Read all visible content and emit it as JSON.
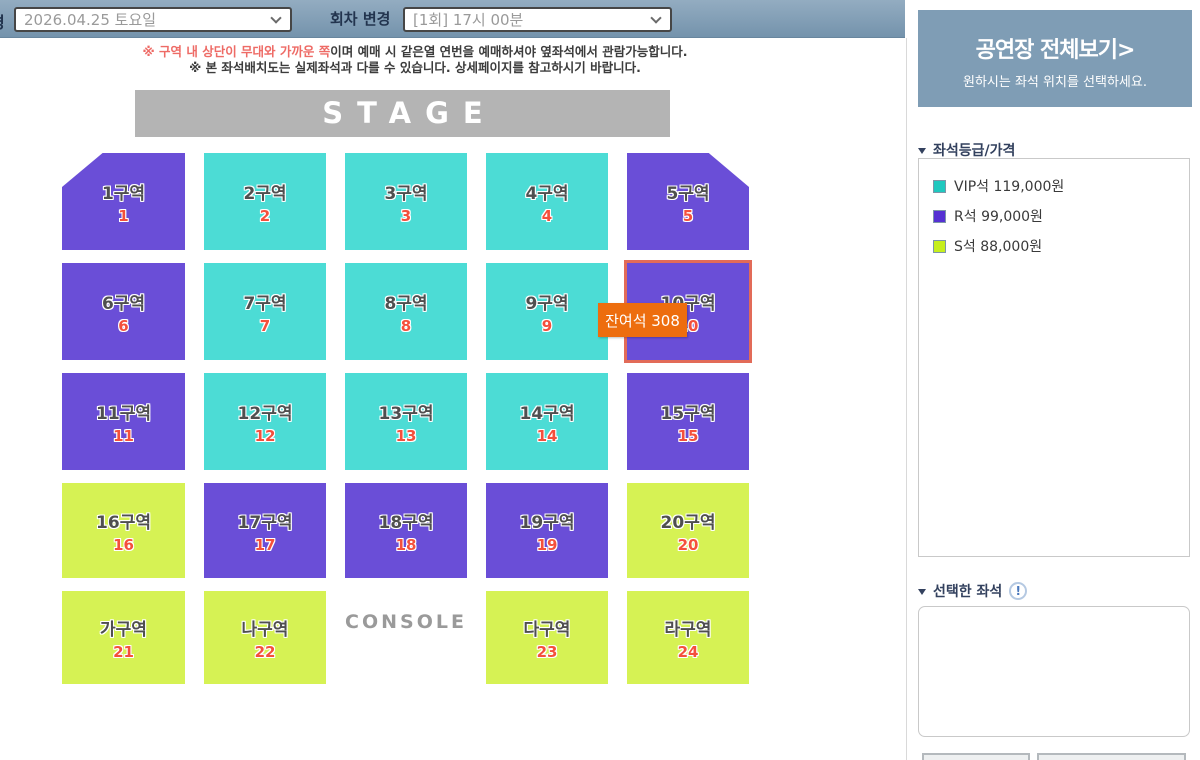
{
  "header": {
    "date_label_partial": "경",
    "date_value": "2026.04.25 토요일",
    "round_label": "회차 변경",
    "round_value": "[1회] 17시 00분"
  },
  "notices": {
    "line1_red": "※ 구역 내 상단이 무대와 가까운 쪽",
    "line1_rest": "이며 예매 시 같은열 연번을 예매하셔야 옆좌석에서 관람가능합니다.",
    "line2": "※ 본 좌석배치도는 실제좌석과 다를 수 있습니다. 상세페이지를 참고하시기 바랍니다."
  },
  "stage_label": "STAGE",
  "console_label": "CONSOLE",
  "tooltip": {
    "text": "잔여석 308"
  },
  "seat_map": {
    "sections": [
      {
        "label": "1구역",
        "number": "1",
        "grade": "R",
        "row": 1,
        "col": 1,
        "shape": "cut-left"
      },
      {
        "label": "2구역",
        "number": "2",
        "grade": "VIP",
        "row": 1,
        "col": 2
      },
      {
        "label": "3구역",
        "number": "3",
        "grade": "VIP",
        "row": 1,
        "col": 3
      },
      {
        "label": "4구역",
        "number": "4",
        "grade": "VIP",
        "row": 1,
        "col": 4
      },
      {
        "label": "5구역",
        "number": "5",
        "grade": "R",
        "row": 1,
        "col": 5,
        "shape": "cut-right"
      },
      {
        "label": "6구역",
        "number": "6",
        "grade": "R",
        "row": 2,
        "col": 1
      },
      {
        "label": "7구역",
        "number": "7",
        "grade": "VIP",
        "row": 2,
        "col": 2
      },
      {
        "label": "8구역",
        "number": "8",
        "grade": "VIP",
        "row": 2,
        "col": 3
      },
      {
        "label": "9구역",
        "number": "9",
        "grade": "VIP",
        "row": 2,
        "col": 4
      },
      {
        "label": "10구역",
        "number": "10",
        "grade": "R",
        "row": 2,
        "col": 5,
        "highlighted": true
      },
      {
        "label": "11구역",
        "number": "11",
        "grade": "R",
        "row": 3,
        "col": 1
      },
      {
        "label": "12구역",
        "number": "12",
        "grade": "VIP",
        "row": 3,
        "col": 2
      },
      {
        "label": "13구역",
        "number": "13",
        "grade": "VIP",
        "row": 3,
        "col": 3
      },
      {
        "label": "14구역",
        "number": "14",
        "grade": "VIP",
        "row": 3,
        "col": 4
      },
      {
        "label": "15구역",
        "number": "15",
        "grade": "R",
        "row": 3,
        "col": 5
      },
      {
        "label": "16구역",
        "number": "16",
        "grade": "S",
        "row": 4,
        "col": 1
      },
      {
        "label": "17구역",
        "number": "17",
        "grade": "R",
        "row": 4,
        "col": 2
      },
      {
        "label": "18구역",
        "number": "18",
        "grade": "R",
        "row": 4,
        "col": 3
      },
      {
        "label": "19구역",
        "number": "19",
        "grade": "R",
        "row": 4,
        "col": 4
      },
      {
        "label": "20구역",
        "number": "20",
        "grade": "S",
        "row": 4,
        "col": 5
      },
      {
        "label": "가구역",
        "number": "21",
        "grade": "S",
        "row": 5,
        "col": 1
      },
      {
        "label": "나구역",
        "number": "22",
        "grade": "S",
        "row": 5,
        "col": 2
      },
      {
        "label": "다구역",
        "number": "23",
        "grade": "S",
        "row": 5,
        "col": 4
      },
      {
        "label": "라구역",
        "number": "24",
        "grade": "S",
        "row": 5,
        "col": 5
      }
    ]
  },
  "sidebar": {
    "overview_title": "공연장 전체보기>",
    "overview_subtitle": "원하시는 좌석 위치를 선택하세요.",
    "price_title": "좌석등급/가격",
    "price_items": [
      {
        "grade": "VIP석",
        "price": "119,000원",
        "color": "#1fc8bf"
      },
      {
        "grade": "R석",
        "price": "99,000원",
        "color": "#5531d3"
      },
      {
        "grade": "S석",
        "price": "88,000원",
        "color": "#c6ef1d"
      }
    ],
    "selected_title": "선택한 좌석",
    "info_icon": "!"
  },
  "colors": {
    "grade_vip_fill": "#4cdcd5",
    "grade_r_fill": "#6a4ed7",
    "grade_s_fill": "#d6f254",
    "stage_fill": "#b4b4b4",
    "tooltip_bg": "#ed6d0e",
    "highlight_border": "#e26b58",
    "header_bar": "#7f9db5",
    "notice_red": "#ee6b66"
  }
}
